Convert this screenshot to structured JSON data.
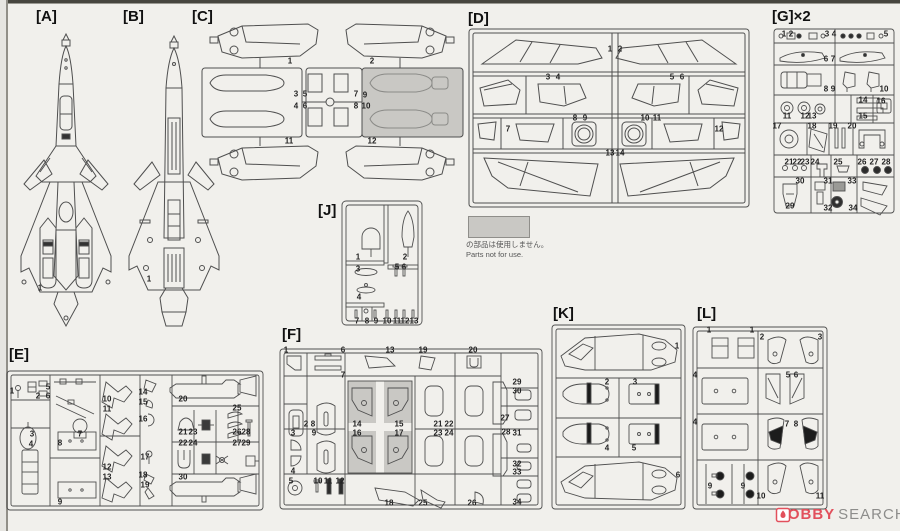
{
  "note": {
    "ja": "の部品は使用しません。",
    "en": "Parts not for use."
  },
  "watermark": {
    "brand_main": "HOBBY",
    "brand_sub": "SEARCH"
  },
  "colors": {
    "paper": "#f1f0ec",
    "line": "#4f4f4f",
    "shade": "#c9c8c4",
    "accent_red": "#e2505c"
  },
  "sections": {
    "a": {
      "label": "[A]",
      "parts": [
        {
          "n": "1",
          "x": 30,
          "y": 283
        }
      ]
    },
    "b": {
      "label": "[B]",
      "parts": [
        {
          "n": "1",
          "x": 27,
          "y": 274
        }
      ]
    },
    "c": {
      "label": "[C]",
      "parts": [
        {
          "n": "1",
          "x": 100,
          "y": 58
        },
        {
          "n": "2",
          "x": 182,
          "y": 58
        },
        {
          "n": "3",
          "x": 106,
          "y": 91
        },
        {
          "n": "5",
          "x": 115,
          "y": 91
        },
        {
          "n": "4",
          "x": 106,
          "y": 103
        },
        {
          "n": "6",
          "x": 115,
          "y": 103
        },
        {
          "n": "7",
          "x": 166,
          "y": 91
        },
        {
          "n": "9",
          "x": 175,
          "y": 92
        },
        {
          "n": "8",
          "x": 166,
          "y": 103
        },
        {
          "n": "10",
          "x": 176,
          "y": 103
        },
        {
          "n": "11",
          "x": 99,
          "y": 138
        },
        {
          "n": "12",
          "x": 182,
          "y": 138
        }
      ]
    },
    "d": {
      "label": "[D]",
      "parts": [
        {
          "n": "1",
          "x": 148,
          "y": 46
        },
        {
          "n": "2",
          "x": 158,
          "y": 46
        },
        {
          "n": "3",
          "x": 86,
          "y": 74
        },
        {
          "n": "4",
          "x": 96,
          "y": 74
        },
        {
          "n": "5",
          "x": 210,
          "y": 74
        },
        {
          "n": "6",
          "x": 220,
          "y": 74
        },
        {
          "n": "7",
          "x": 46,
          "y": 126
        },
        {
          "n": "8",
          "x": 113,
          "y": 115
        },
        {
          "n": "9",
          "x": 123,
          "y": 115
        },
        {
          "n": "10",
          "x": 183,
          "y": 115
        },
        {
          "n": "11",
          "x": 195,
          "y": 115
        },
        {
          "n": "12",
          "x": 257,
          "y": 126
        },
        {
          "n": "13",
          "x": 148,
          "y": 150
        },
        {
          "n": "14",
          "x": 158,
          "y": 150
        }
      ]
    },
    "e": {
      "label": "[E]",
      "parts": [
        {
          "n": "1",
          "x": 6,
          "y": 46
        },
        {
          "n": "2",
          "x": 32,
          "y": 51
        },
        {
          "n": "5",
          "x": 42,
          "y": 42
        },
        {
          "n": "6",
          "x": 42,
          "y": 51
        },
        {
          "n": "3",
          "x": 26,
          "y": 89
        },
        {
          "n": "4",
          "x": 25,
          "y": 99
        },
        {
          "n": "7",
          "x": 74,
          "y": 89
        },
        {
          "n": "8",
          "x": 54,
          "y": 98
        },
        {
          "n": "9",
          "x": 54,
          "y": 157
        },
        {
          "n": "10",
          "x": 101,
          "y": 54
        },
        {
          "n": "11",
          "x": 101,
          "y": 64
        },
        {
          "n": "12",
          "x": 101,
          "y": 122
        },
        {
          "n": "13",
          "x": 101,
          "y": 132
        },
        {
          "n": "14",
          "x": 137,
          "y": 47
        },
        {
          "n": "15",
          "x": 137,
          "y": 57
        },
        {
          "n": "16",
          "x": 137,
          "y": 74
        },
        {
          "n": "17",
          "x": 139,
          "y": 112
        },
        {
          "n": "18",
          "x": 137,
          "y": 130
        },
        {
          "n": "19",
          "x": 139,
          "y": 140
        },
        {
          "n": "20",
          "x": 177,
          "y": 54
        },
        {
          "n": "21",
          "x": 177,
          "y": 87
        },
        {
          "n": "22",
          "x": 177,
          "y": 98
        },
        {
          "n": "23",
          "x": 187,
          "y": 87
        },
        {
          "n": "24",
          "x": 187,
          "y": 98
        },
        {
          "n": "25",
          "x": 231,
          "y": 63
        },
        {
          "n": "26",
          "x": 231,
          "y": 87
        },
        {
          "n": "27",
          "x": 231,
          "y": 98
        },
        {
          "n": "28",
          "x": 240,
          "y": 87
        },
        {
          "n": "29",
          "x": 240,
          "y": 98
        },
        {
          "n": "30",
          "x": 177,
          "y": 132
        }
      ]
    },
    "f": {
      "label": "[F]",
      "parts": [
        {
          "n": "1",
          "x": 8,
          "y": 25
        },
        {
          "n": "6",
          "x": 65,
          "y": 25
        },
        {
          "n": "13",
          "x": 112,
          "y": 25
        },
        {
          "n": "19",
          "x": 145,
          "y": 25
        },
        {
          "n": "20",
          "x": 195,
          "y": 25
        },
        {
          "n": "7",
          "x": 65,
          "y": 50
        },
        {
          "n": "29",
          "x": 239,
          "y": 57
        },
        {
          "n": "30",
          "x": 239,
          "y": 66
        },
        {
          "n": "2",
          "x": 28,
          "y": 99
        },
        {
          "n": "8",
          "x": 35,
          "y": 99
        },
        {
          "n": "14",
          "x": 79,
          "y": 99
        },
        {
          "n": "15",
          "x": 121,
          "y": 99
        },
        {
          "n": "21",
          "x": 160,
          "y": 99
        },
        {
          "n": "22",
          "x": 171,
          "y": 99
        },
        {
          "n": "27",
          "x": 227,
          "y": 93
        },
        {
          "n": "3",
          "x": 15,
          "y": 108
        },
        {
          "n": "9",
          "x": 36,
          "y": 108
        },
        {
          "n": "16",
          "x": 79,
          "y": 108
        },
        {
          "n": "17",
          "x": 121,
          "y": 108
        },
        {
          "n": "23",
          "x": 160,
          "y": 108
        },
        {
          "n": "24",
          "x": 171,
          "y": 108
        },
        {
          "n": "28",
          "x": 228,
          "y": 107
        },
        {
          "n": "31",
          "x": 239,
          "y": 108
        },
        {
          "n": "4",
          "x": 15,
          "y": 146
        },
        {
          "n": "5",
          "x": 13,
          "y": 156
        },
        {
          "n": "10",
          "x": 40,
          "y": 156
        },
        {
          "n": "11",
          "x": 50,
          "y": 156
        },
        {
          "n": "12",
          "x": 62,
          "y": 156
        },
        {
          "n": "32",
          "x": 239,
          "y": 139
        },
        {
          "n": "33",
          "x": 239,
          "y": 147
        },
        {
          "n": "18",
          "x": 111,
          "y": 178
        },
        {
          "n": "25",
          "x": 145,
          "y": 178
        },
        {
          "n": "26",
          "x": 194,
          "y": 178
        },
        {
          "n": "34",
          "x": 239,
          "y": 177
        }
      ]
    },
    "g": {
      "label": "[G]×2",
      "parts": [
        {
          "n": "1",
          "x": 14,
          "y": 31
        },
        {
          "n": "2",
          "x": 21,
          "y": 31
        },
        {
          "n": "3",
          "x": 57,
          "y": 31
        },
        {
          "n": "4",
          "x": 64,
          "y": 31
        },
        {
          "n": "5",
          "x": 116,
          "y": 31
        },
        {
          "n": "6",
          "x": 56,
          "y": 56
        },
        {
          "n": "7",
          "x": 63,
          "y": 56
        },
        {
          "n": "8",
          "x": 56,
          "y": 86
        },
        {
          "n": "9",
          "x": 63,
          "y": 86
        },
        {
          "n": "10",
          "x": 114,
          "y": 86
        },
        {
          "n": "11",
          "x": 17,
          "y": 113
        },
        {
          "n": "12",
          "x": 35,
          "y": 113
        },
        {
          "n": "13",
          "x": 42,
          "y": 113
        },
        {
          "n": "14",
          "x": 93,
          "y": 97
        },
        {
          "n": "15",
          "x": 93,
          "y": 113
        },
        {
          "n": "16",
          "x": 111,
          "y": 98
        },
        {
          "n": "17",
          "x": 7,
          "y": 123
        },
        {
          "n": "18",
          "x": 42,
          "y": 123
        },
        {
          "n": "19",
          "x": 63,
          "y": 123
        },
        {
          "n": "20",
          "x": 82,
          "y": 123
        },
        {
          "n": "21",
          "x": 19,
          "y": 159
        },
        {
          "n": "22",
          "x": 27,
          "y": 159
        },
        {
          "n": "23",
          "x": 35,
          "y": 159
        },
        {
          "n": "24",
          "x": 45,
          "y": 159
        },
        {
          "n": "25",
          "x": 68,
          "y": 159
        },
        {
          "n": "26",
          "x": 92,
          "y": 159
        },
        {
          "n": "27",
          "x": 104,
          "y": 159
        },
        {
          "n": "28",
          "x": 116,
          "y": 159
        },
        {
          "n": "30",
          "x": 30,
          "y": 178
        },
        {
          "n": "31",
          "x": 58,
          "y": 178
        },
        {
          "n": "33",
          "x": 82,
          "y": 178
        },
        {
          "n": "29",
          "x": 20,
          "y": 203
        },
        {
          "n": "32",
          "x": 58,
          "y": 205
        },
        {
          "n": "34",
          "x": 83,
          "y": 205
        }
      ]
    },
    "j": {
      "label": "[J]",
      "parts": [
        {
          "n": "1",
          "x": 43,
          "y": 60
        },
        {
          "n": "2",
          "x": 90,
          "y": 60
        },
        {
          "n": "3",
          "x": 43,
          "y": 72
        },
        {
          "n": "5",
          "x": 82,
          "y": 70
        },
        {
          "n": "6",
          "x": 89,
          "y": 70
        },
        {
          "n": "4",
          "x": 44,
          "y": 100
        },
        {
          "n": "7",
          "x": 42,
          "y": 124
        },
        {
          "n": "8",
          "x": 52,
          "y": 124
        },
        {
          "n": "9",
          "x": 61,
          "y": 124
        },
        {
          "n": "10",
          "x": 72,
          "y": 124
        },
        {
          "n": "11",
          "x": 82,
          "y": 124
        },
        {
          "n": "12",
          "x": 90,
          "y": 124
        },
        {
          "n": "13",
          "x": 99,
          "y": 124
        }
      ]
    },
    "k": {
      "label": "[K]",
      "parts": [
        {
          "n": "1",
          "x": 129,
          "y": 47
        },
        {
          "n": "2",
          "x": 59,
          "y": 83
        },
        {
          "n": "3",
          "x": 87,
          "y": 83
        },
        {
          "n": "4",
          "x": 59,
          "y": 149
        },
        {
          "n": "5",
          "x": 86,
          "y": 149
        },
        {
          "n": "6",
          "x": 130,
          "y": 176
        }
      ]
    },
    "l": {
      "label": "[L]",
      "parts": [
        {
          "n": "1",
          "x": 17,
          "y": 31
        },
        {
          "n": "1",
          "x": 60,
          "y": 31
        },
        {
          "n": "2",
          "x": 70,
          "y": 38
        },
        {
          "n": "3",
          "x": 128,
          "y": 38
        },
        {
          "n": "4",
          "x": 3,
          "y": 76
        },
        {
          "n": "5",
          "x": 96,
          "y": 76
        },
        {
          "n": "6",
          "x": 104,
          "y": 76
        },
        {
          "n": "4",
          "x": 3,
          "y": 123
        },
        {
          "n": "7",
          "x": 95,
          "y": 125
        },
        {
          "n": "8",
          "x": 104,
          "y": 125
        },
        {
          "n": "9",
          "x": 18,
          "y": 187
        },
        {
          "n": "9",
          "x": 51,
          "y": 187
        },
        {
          "n": "10",
          "x": 69,
          "y": 197
        },
        {
          "n": "11",
          "x": 128,
          "y": 197
        }
      ]
    }
  }
}
